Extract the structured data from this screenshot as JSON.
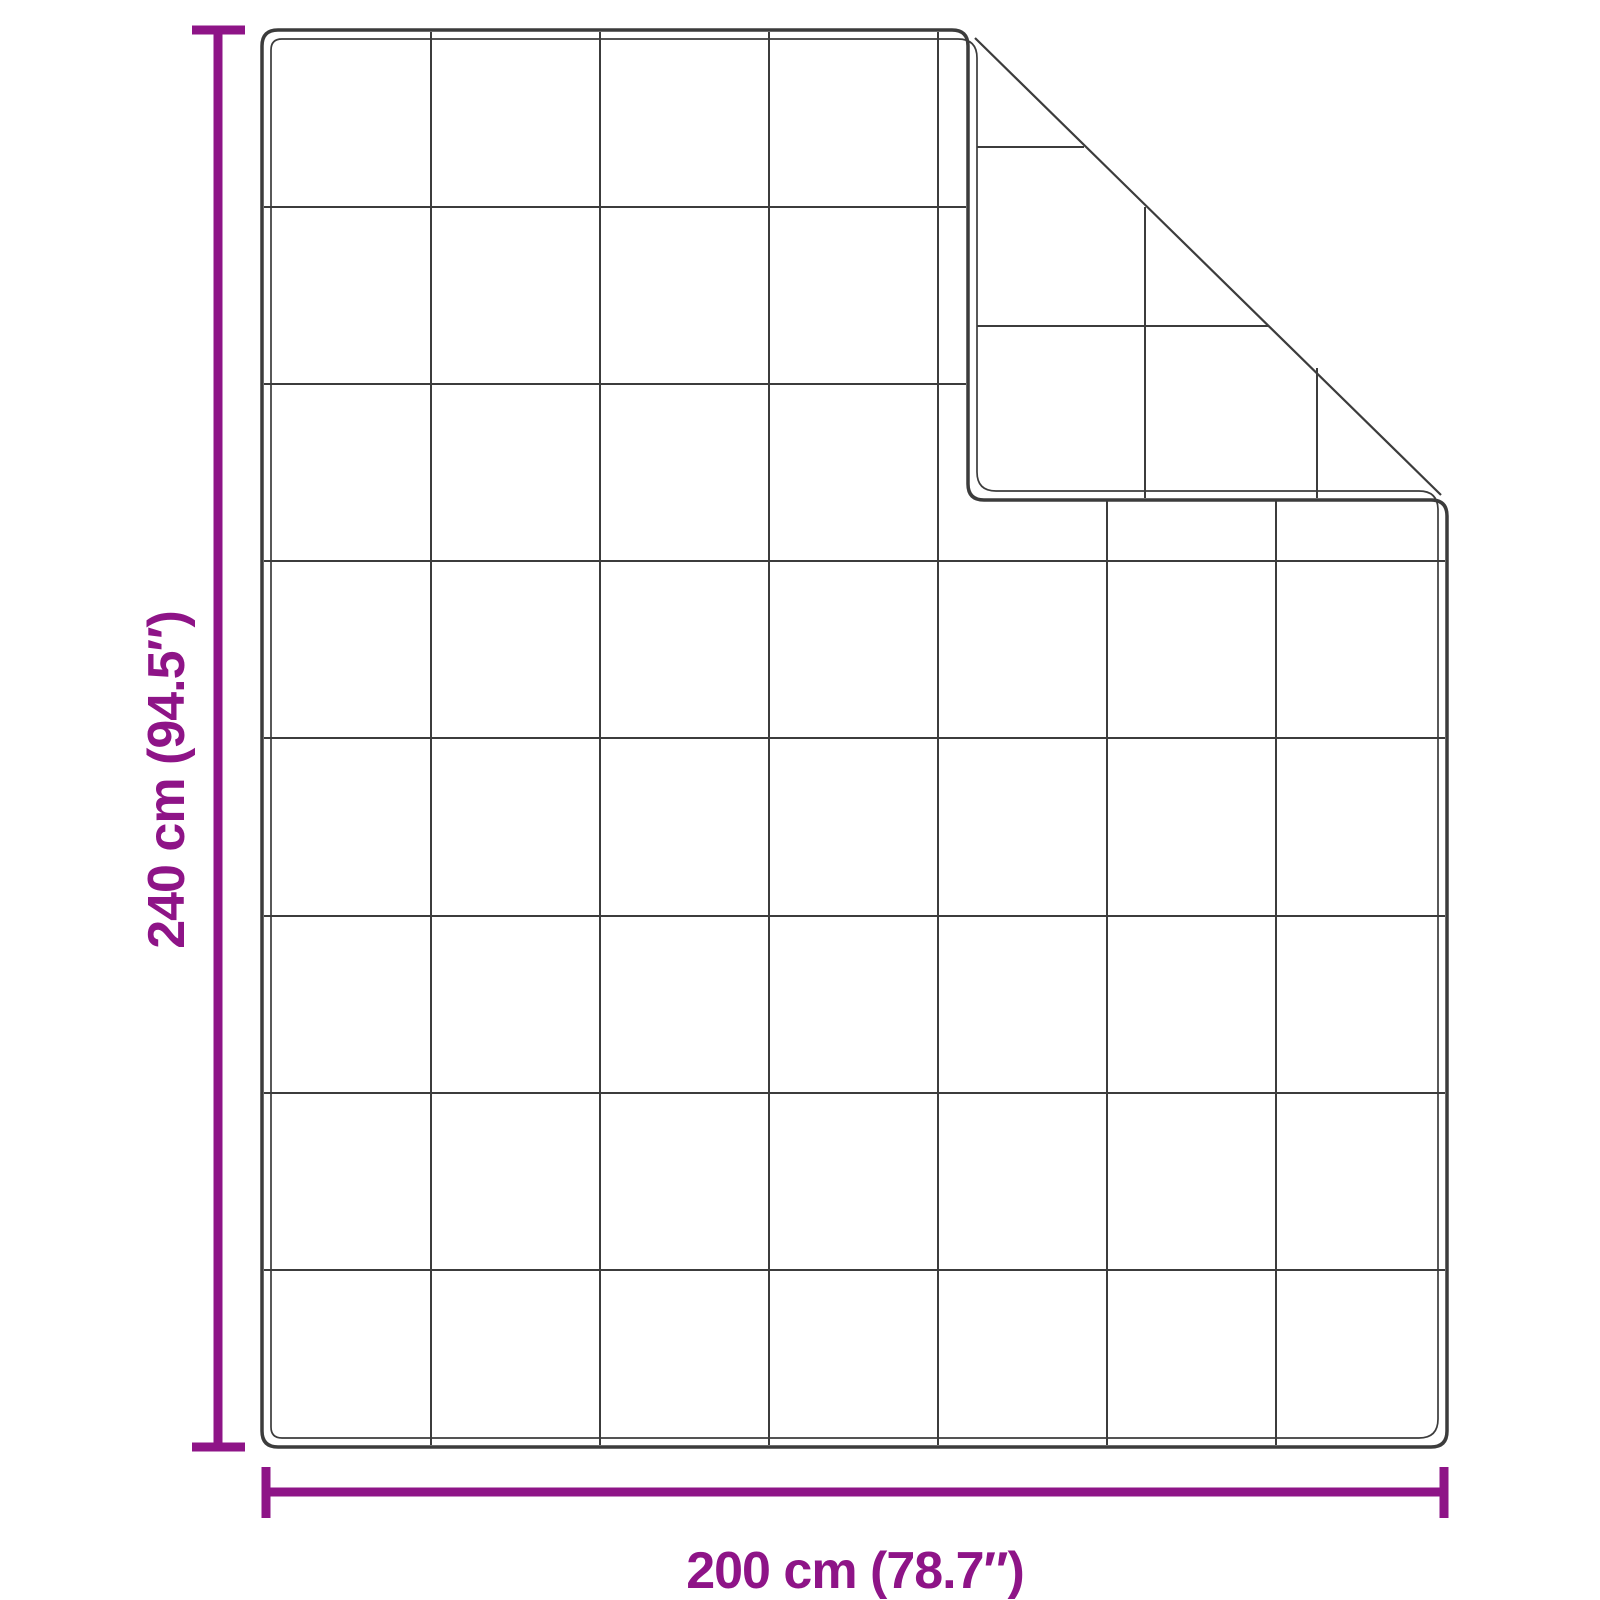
{
  "labels": {
    "height": "240 cm (94.5″)",
    "width": "200 cm (78.7″)"
  },
  "colors": {
    "dimension_accent": "#8E1487",
    "outline": "#3C3C3C",
    "background": "#FFFFFF"
  },
  "blanket": {
    "quilt_columns": 7,
    "quilt_rows": 8,
    "folded_corner": "top-right"
  }
}
